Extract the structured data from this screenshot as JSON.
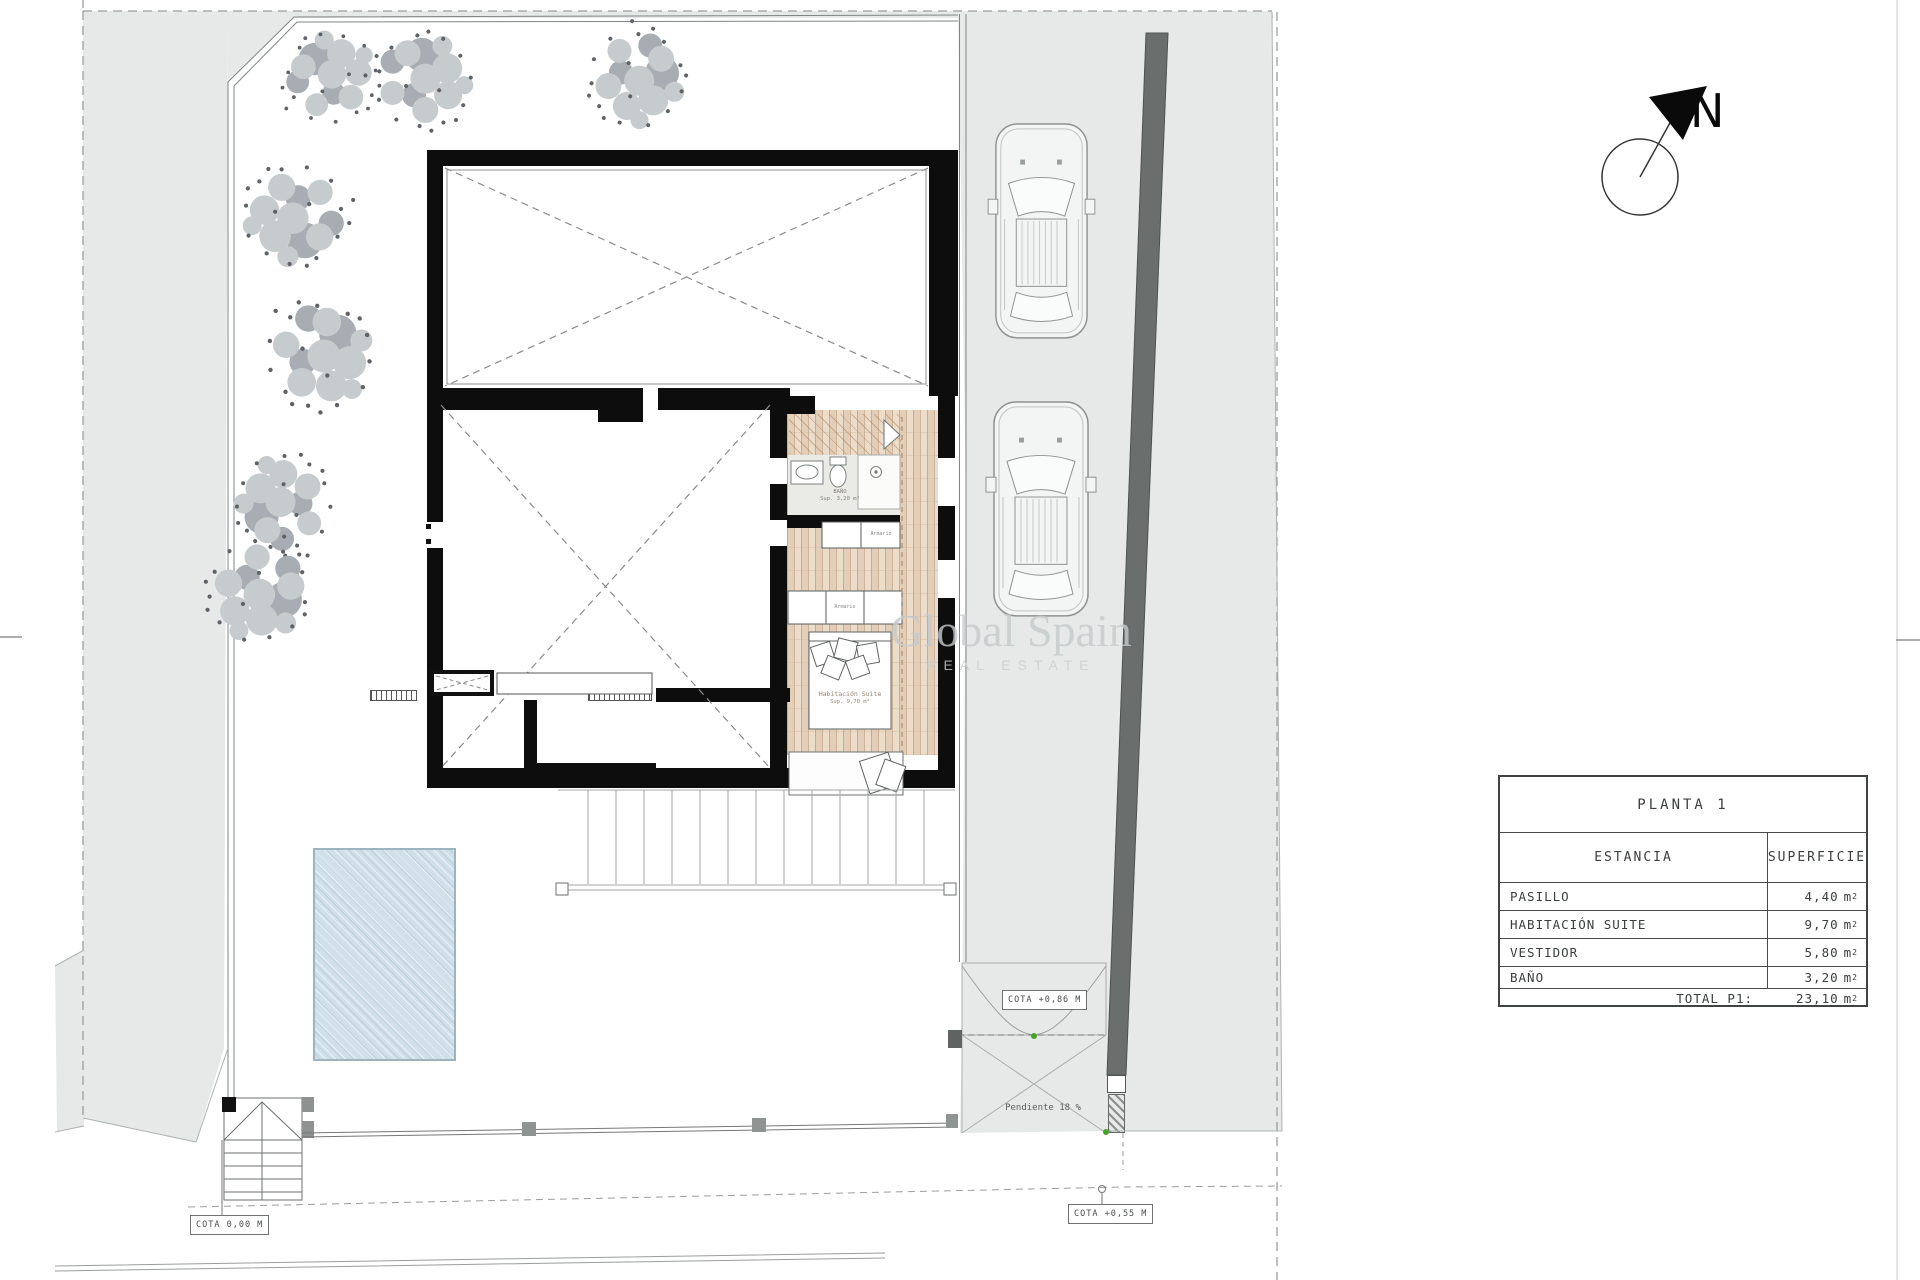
{
  "table": {
    "title": "PLANTA 1",
    "col_estancia": "ESTANCIA",
    "col_superficie": "SUPERFICIE",
    "rows": [
      {
        "name": "PASILLO",
        "area": "4,40"
      },
      {
        "name": "HABITACIÓN SUITE",
        "area": "9,70"
      },
      {
        "name": "VESTIDOR",
        "area": "5,80"
      },
      {
        "name": "BAÑO",
        "area": "3,20"
      }
    ],
    "total_label": "TOTAL P1:",
    "total_value": "23,10"
  },
  "units": {
    "m": "m",
    "sup": "2"
  },
  "compass": {
    "letter": "N"
  },
  "watermark": {
    "line1": "Global Spain",
    "line2": "REAL ESTATE"
  },
  "annotations": {
    "cota_0": "COTA 0,00 M",
    "cota_055": "COTA +0,55 M",
    "cota_086": "COTA +0,86 M",
    "pendiente": "Pendiente 18 %"
  },
  "rooms": {
    "bath_name": "BAÑO",
    "bath_area": "Sup. 3,20 m²",
    "suite_name": "Habitación Suite",
    "suite_area": "Sup. 9,70 m²",
    "armario": "Armario"
  },
  "colors": {
    "terrain": "#e7e9e8",
    "boundary_wall": "#6a6e6d",
    "building_wall": "#0d0d0d",
    "wood_floor": "#ecddcb",
    "pool": "#d0e0e8",
    "gate_dot_green": "#44a32a"
  }
}
